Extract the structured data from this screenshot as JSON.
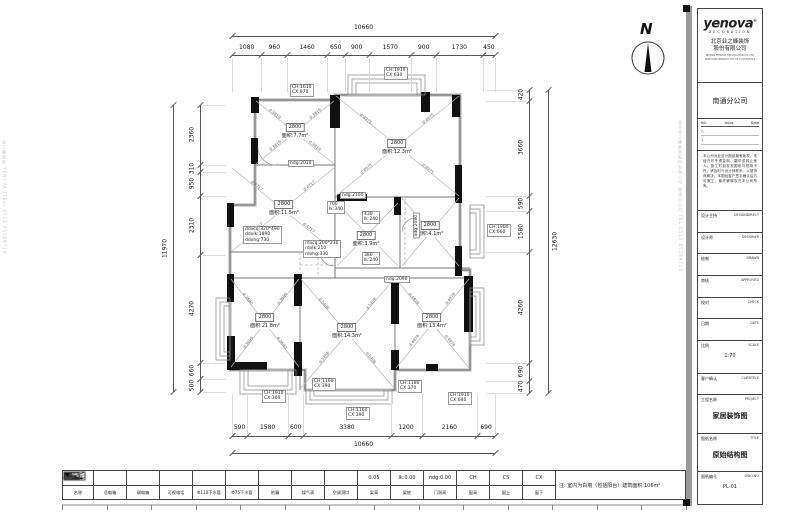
{
  "north": {
    "label": "N"
  },
  "note": "注: 室内为白墙（包括阳台）建筑面积:106m²",
  "watermarks": {
    "left": "业之峰装饰 YENOVA (TEL) 0513 85289710",
    "right": "北京业之峰装饰股份有限公司 南通分公司 TEL:0513 85289710"
  },
  "dimensions": {
    "top": {
      "total": "10660",
      "segments": [
        "1080",
        "960",
        "1460",
        "650",
        "900",
        "1570",
        "900",
        "1730",
        "450"
      ]
    },
    "bottom": {
      "total": "10660",
      "segments": [
        "590",
        "1580",
        "600",
        "3380",
        "1200",
        "2160",
        "690"
      ]
    },
    "left": {
      "total": "11970",
      "segments": [
        "2360",
        "310",
        "950",
        "2310",
        "4270",
        "660",
        "500"
      ]
    },
    "right": {
      "total": "12630",
      "segments": [
        "420",
        "3660",
        "590",
        "1580",
        "4260",
        "690",
        "470"
      ]
    }
  },
  "plan": {
    "rooms": [
      {
        "h": "2800",
        "a": "面积:7.7m²",
        "x": 295,
        "y": 126
      },
      {
        "h": "2800",
        "a": "面积:11.5m²",
        "x": 284,
        "y": 203
      },
      {
        "h": "2800",
        "a": "面积:12.3m²",
        "x": 397,
        "y": 142
      },
      {
        "h": "2800",
        "a": "面积:3.9m²",
        "x": 366,
        "y": 234
      },
      {
        "h": "2800",
        "a": "面积:4.1m²",
        "x": 430,
        "y": 224
      },
      {
        "h": "2800",
        "a": "面积:21.8m²",
        "x": 265,
        "y": 316
      },
      {
        "h": "2800",
        "a": "面积:14.3m²",
        "x": 347,
        "y": 326
      },
      {
        "h": "2800",
        "a": "面积:13.4m²",
        "x": 432,
        "y": 316
      }
    ],
    "diagonals": [
      {
        "t": "d:3819",
        "x": 275,
        "y": 114,
        "r": 39
      },
      {
        "t": "d:3819",
        "x": 315,
        "y": 114,
        "r": -39
      },
      {
        "t": "d:3819",
        "x": 275,
        "y": 146,
        "r": -39
      },
      {
        "t": "d:3819",
        "x": 315,
        "y": 146,
        "r": 39
      },
      {
        "t": "d:4717",
        "x": 257,
        "y": 186,
        "r": 39
      },
      {
        "t": "d:4717",
        "x": 309,
        "y": 186,
        "r": -39
      },
      {
        "t": "d:4717",
        "x": 257,
        "y": 228,
        "r": -39
      },
      {
        "t": "d:4717",
        "x": 309,
        "y": 228,
        "r": 39
      },
      {
        "t": "d:4975",
        "x": 366,
        "y": 119,
        "r": 39
      },
      {
        "t": "d:4975",
        "x": 428,
        "y": 119,
        "r": -39
      },
      {
        "t": "d:4975",
        "x": 366,
        "y": 169,
        "r": -39
      },
      {
        "t": "d:4975",
        "x": 428,
        "y": 169,
        "r": 39
      },
      {
        "t": "d:3690",
        "x": 248,
        "y": 299,
        "r": 52
      },
      {
        "t": "d:3690",
        "x": 282,
        "y": 299,
        "r": -52
      },
      {
        "t": "d:3690",
        "x": 248,
        "y": 343,
        "r": -52
      },
      {
        "t": "d:3690",
        "x": 282,
        "y": 343,
        "r": 52
      },
      {
        "t": "d:5408",
        "x": 324,
        "y": 304,
        "r": 50
      },
      {
        "t": "d:5408",
        "x": 371,
        "y": 304,
        "r": -50
      },
      {
        "t": "d:5408",
        "x": 324,
        "y": 358,
        "r": -50
      },
      {
        "t": "d:5408",
        "x": 371,
        "y": 358,
        "r": 50
      },
      {
        "t": "d:4878",
        "x": 414,
        "y": 299,
        "r": 51
      },
      {
        "t": "d:4878",
        "x": 450,
        "y": 299,
        "r": -51
      },
      {
        "t": "d:4878",
        "x": 414,
        "y": 341,
        "r": -51
      },
      {
        "t": "d:4878",
        "x": 450,
        "y": 341,
        "r": 51
      }
    ],
    "callouts": [
      {
        "lines": [
          "CH:1610",
          "CX:970"
        ],
        "x": 290,
        "y": 84
      },
      {
        "lines": [
          "CH:1910",
          "CX:630"
        ],
        "x": 384,
        "y": 67
      },
      {
        "lines": [
          "CH:1900",
          "CX:660"
        ],
        "x": 487,
        "y": 224
      },
      {
        "lines": [
          "CH:1910",
          "CX:300"
        ],
        "x": 262,
        "y": 390
      },
      {
        "lines": [
          "CH:1160",
          "CX:390"
        ],
        "x": 312,
        "y": 378
      },
      {
        "lines": [
          "CH:1160",
          "CX:390"
        ],
        "x": 346,
        "y": 407
      },
      {
        "lines": [
          "CH:1180",
          "CX:370"
        ],
        "x": 398,
        "y": 380
      },
      {
        "lines": [
          "CH:1910",
          "CX:640"
        ],
        "x": 448,
        "y": 392
      },
      {
        "lines": [
          "ndg:2010"
        ],
        "x": 288,
        "y": 160
      },
      {
        "lines": [
          "ndg:2100"
        ],
        "x": 340,
        "y": 192
      },
      {
        "lines": [
          "ndg:2090"
        ],
        "x": 384,
        "y": 276
      },
      {
        "lines": [
          "700",
          "lk:340"
        ],
        "x": 327,
        "y": 201
      },
      {
        "lines": [
          "430",
          "lk:240"
        ],
        "x": 362,
        "y": 211
      },
      {
        "lines": [
          "380",
          "lk:240"
        ],
        "x": 362,
        "y": 252
      },
      {
        "lines": [
          "ddxcq:320*490",
          "ddxlk:1890",
          "ddxhg:730"
        ],
        "x": 243,
        "y": 226
      },
      {
        "lines": [
          "rdxcq:200*230",
          "rdxlk:210",
          "rdxhg:330"
        ],
        "x": 303,
        "y": 240
      },
      {
        "lines": [
          "ndg:2080"
        ],
        "x": 404,
        "y": 222,
        "vert": true
      }
    ]
  },
  "legend": {
    "header1": "图例",
    "header2": "名称",
    "items": [
      {
        "label": "总电箱",
        "sym": "wedge"
      },
      {
        "label": "弱电箱",
        "sym": "diagbox"
      },
      {
        "label": "可视电话",
        "sym": "linesbox"
      },
      {
        "label": "Φ110下水管",
        "sym": "circle"
      },
      {
        "label": "Φ75下水管",
        "sym": "circlesm"
      },
      {
        "label": "地漏",
        "sym": "drain"
      },
      {
        "label": "煤气表",
        "sym": "gasbox"
      },
      {
        "label": "空调洞口",
        "sym": "acircle"
      },
      {
        "label": "梁高",
        "sym": "flag",
        "text": "0.05"
      },
      {
        "label": "梁底",
        "sym": "text",
        "text": "lk:0.00"
      },
      {
        "label": "门洞高",
        "sym": "text",
        "text": "ndg:0.00"
      },
      {
        "label": "窗高",
        "sym": "text",
        "text": "CH"
      },
      {
        "label": "窗上",
        "sym": "text",
        "text": "CS"
      },
      {
        "label": "窗下",
        "sym": "text",
        "text": "CX"
      }
    ]
  },
  "title_block": {
    "logo": "yenova",
    "logo_sub": "DECORATION",
    "company_cn1": "北京业之峰装饰",
    "company_cn2": "股份有限公司",
    "company_en1": "BEIJING YENOVA DECORATION CO.,LTD",
    "company_en2": "NANTONG BRANCH TEL:0513 85289710",
    "branch": "南通分公司",
    "issue_no": "NO.",
    "issue_issue": "Issue",
    "issue_date": "Date",
    "issue_rows": [
      "△",
      "1"
    ],
    "disclaimer": "本公司对此设计图纸拥有版权，未经许可不得复制、翻印或转让他人。施工时如发现图纸与现场不符，请及时与设计师联系，以便协商解决。本图经客户签字确认后方可施工，最终解释权归本公司所有。",
    "rows": [
      {
        "cn": "设计主持",
        "en": "DESIGNDIRECT",
        "value": "",
        "size": ""
      },
      {
        "cn": "设计师",
        "en": "DESIGNER",
        "value": "",
        "size": ""
      },
      {
        "cn": "绘制",
        "en": "DRAWN",
        "value": "",
        "size": ""
      },
      {
        "cn": "审核",
        "en": "APPROVED",
        "value": "",
        "size": ""
      },
      {
        "cn": "校对",
        "en": "CHECK",
        "value": "",
        "size": ""
      },
      {
        "cn": "日期",
        "en": "DATE",
        "value": "",
        "size": ""
      },
      {
        "cn": "比例",
        "en": "SCALE",
        "value": "1:70",
        "size": "small"
      },
      {
        "cn": "客户确认",
        "en": "CLIENTELE",
        "value": "",
        "size": ""
      },
      {
        "cn": "工程名称",
        "en": "PROJECT",
        "value": "家居装饰图",
        "size": "big"
      },
      {
        "cn": "图纸名称",
        "en": "TITLE",
        "value": "原始结构图",
        "size": "big"
      },
      {
        "cn": "图纸编号",
        "en": "DWG.NO",
        "value": "PL-01",
        "size": "small"
      }
    ]
  }
}
